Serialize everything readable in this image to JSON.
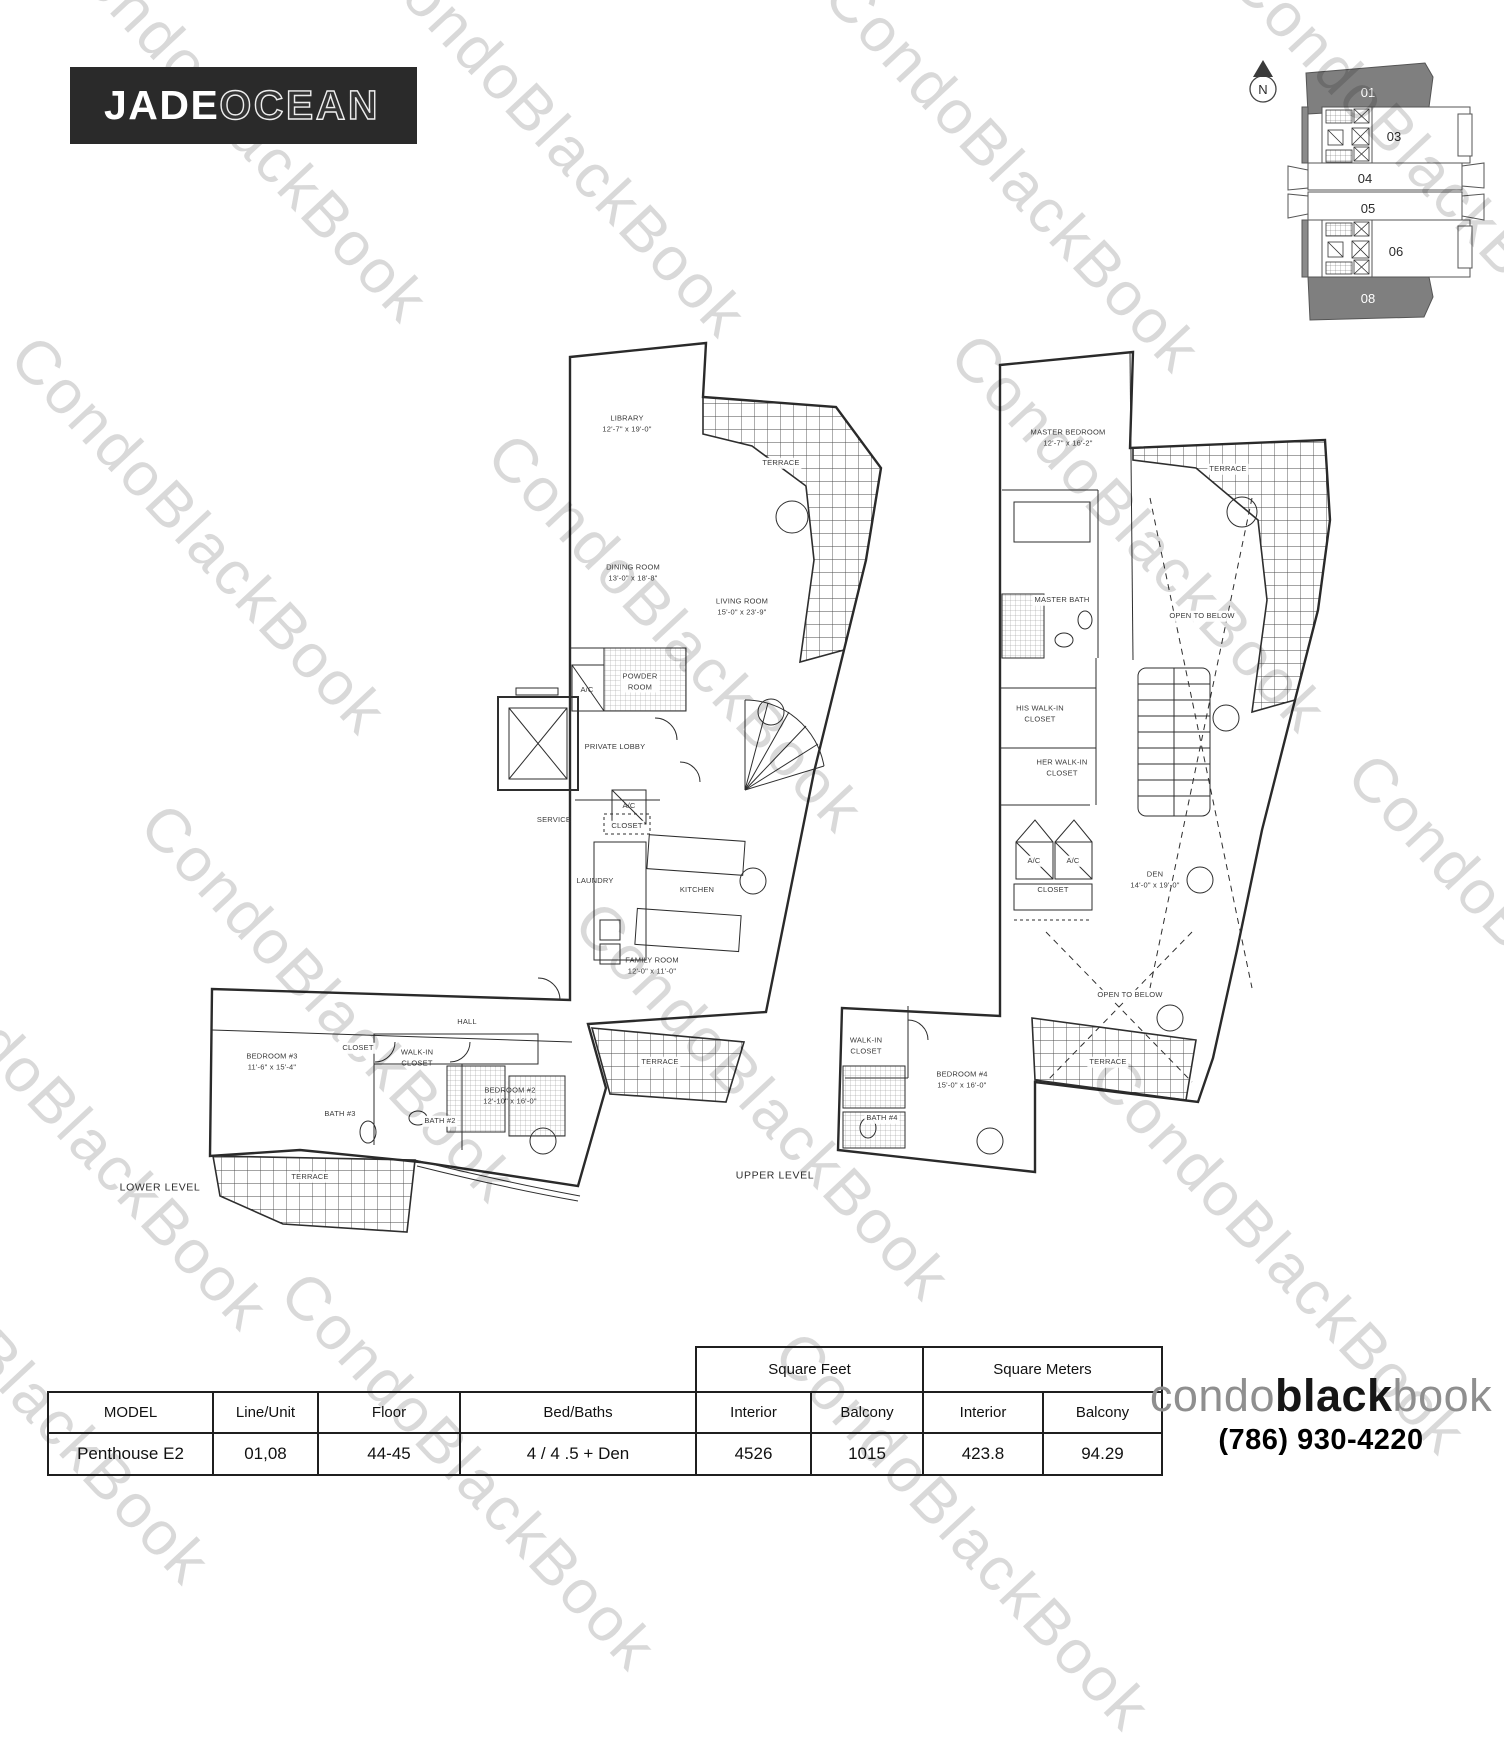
{
  "branding": {
    "logo_primary": "JADE",
    "logo_secondary": "OCEAN",
    "watermark": "CondoBlackBook",
    "footer_logo": {
      "part1": "condo",
      "part2": "black",
      "part3": "book"
    },
    "phone": "(786) 930-4220"
  },
  "keyplan": {
    "north_label": "N",
    "units": [
      {
        "label": "01",
        "highlighted": true
      },
      {
        "label": "03",
        "highlighted": false
      },
      {
        "label": "04",
        "highlighted": false
      },
      {
        "label": "05",
        "highlighted": false
      },
      {
        "label": "06",
        "highlighted": false
      },
      {
        "label": "08",
        "highlighted": true
      }
    ]
  },
  "floorplan": {
    "labels": [
      {
        "t": "LIBRARY",
        "d": "12'-7\" x 19'-0\"",
        "x": 627,
        "y": 424
      },
      {
        "t": "TERRACE",
        "x": 781,
        "y": 463,
        "bg": 1
      },
      {
        "t": "DINING ROOM",
        "d": "13'-0\" x 18'-8\"",
        "x": 633,
        "y": 573
      },
      {
        "t": "LIVING ROOM",
        "d": "15'-0\" x 23'-9\"",
        "x": 742,
        "y": 607
      },
      {
        "t": "A/C",
        "x": 587,
        "y": 690
      },
      {
        "t": "POWDER",
        "d": "ROOM",
        "x": 640,
        "y": 682,
        "bg": 1
      },
      {
        "t": "PRIVATE LOBBY",
        "x": 615,
        "y": 747
      },
      {
        "t": "A/C",
        "x": 629,
        "y": 806
      },
      {
        "t": "SERVICE",
        "x": 554,
        "y": 820
      },
      {
        "t": "CLOSET",
        "x": 627,
        "y": 826,
        "bg": 1
      },
      {
        "t": "LAUNDRY",
        "x": 595,
        "y": 881
      },
      {
        "t": "KITCHEN",
        "x": 697,
        "y": 890
      },
      {
        "t": "FAMILY ROOM",
        "d": "12'-0\" x 11'-0\"",
        "x": 652,
        "y": 966
      },
      {
        "t": "HALL",
        "x": 467,
        "y": 1022
      },
      {
        "t": "CLOSET",
        "x": 358,
        "y": 1048,
        "bg": 1
      },
      {
        "t": "BEDROOM #3",
        "d": "11'-6\" x 15'-4\"",
        "x": 272,
        "y": 1062
      },
      {
        "t": "WALK-IN",
        "d": "CLOSET",
        "x": 417,
        "y": 1058
      },
      {
        "t": "BEDROOM #2",
        "d": "12'-10\" x 16'-0\"",
        "x": 510,
        "y": 1096
      },
      {
        "t": "BATH #3",
        "x": 340,
        "y": 1114,
        "bg": 1
      },
      {
        "t": "BATH #2",
        "x": 440,
        "y": 1121,
        "bg": 1
      },
      {
        "t": "TERRACE",
        "x": 310,
        "y": 1177,
        "bg": 1
      },
      {
        "t": "TERRACE",
        "x": 660,
        "y": 1062,
        "bg": 1
      },
      {
        "t": "LOWER LEVEL",
        "x": 160,
        "y": 1188,
        "big": 1
      },
      {
        "t": "MASTER BEDROOM",
        "d": "12'-7\" x 16'-2\"",
        "x": 1068,
        "y": 438
      },
      {
        "t": "TERRACE",
        "x": 1228,
        "y": 469,
        "bg": 1
      },
      {
        "t": "MASTER BATH",
        "x": 1062,
        "y": 600,
        "bg": 1
      },
      {
        "t": "OPEN TO BELOW",
        "x": 1202,
        "y": 616,
        "bg": 1
      },
      {
        "t": "HIS WALK-IN",
        "d": "CLOSET",
        "x": 1040,
        "y": 714
      },
      {
        "t": "HER WALK-IN",
        "d": "CLOSET",
        "x": 1062,
        "y": 768
      },
      {
        "t": "A/C",
        "x": 1034,
        "y": 861,
        "bg": 1
      },
      {
        "t": "A/C",
        "x": 1073,
        "y": 861,
        "bg": 1
      },
      {
        "t": "CLOSET",
        "x": 1053,
        "y": 890,
        "bg": 1
      },
      {
        "t": "DEN",
        "d": "14'-0\" x 19'-0\"",
        "x": 1155,
        "y": 880
      },
      {
        "t": "OPEN TO BELOW",
        "x": 1130,
        "y": 995,
        "bg": 1
      },
      {
        "t": "WALK-IN",
        "d": "CLOSET",
        "x": 866,
        "y": 1046
      },
      {
        "t": "BEDROOM #4",
        "d": "15'-0\" x 16'-0\"",
        "x": 962,
        "y": 1080
      },
      {
        "t": "BATH #4",
        "x": 882,
        "y": 1118,
        "bg": 1
      },
      {
        "t": "TERRACE",
        "x": 1108,
        "y": 1062,
        "bg": 1
      },
      {
        "t": "UPPER LEVEL",
        "x": 775,
        "y": 1176,
        "big": 1
      }
    ]
  },
  "table": {
    "group_headers": [
      {
        "label": "Square Feet"
      },
      {
        "label": "Square Meters"
      }
    ],
    "columns": [
      "MODEL",
      "Line/Unit",
      "Floor",
      "Bed/Baths",
      "Interior",
      "Balcony",
      "Interior",
      "Balcony"
    ],
    "rows": [
      [
        "Penthouse E2",
        "01,08",
        "44-45",
        "4 / 4 .5 + Den",
        "4526",
        "1015",
        "423.8",
        "94.29"
      ]
    ]
  }
}
